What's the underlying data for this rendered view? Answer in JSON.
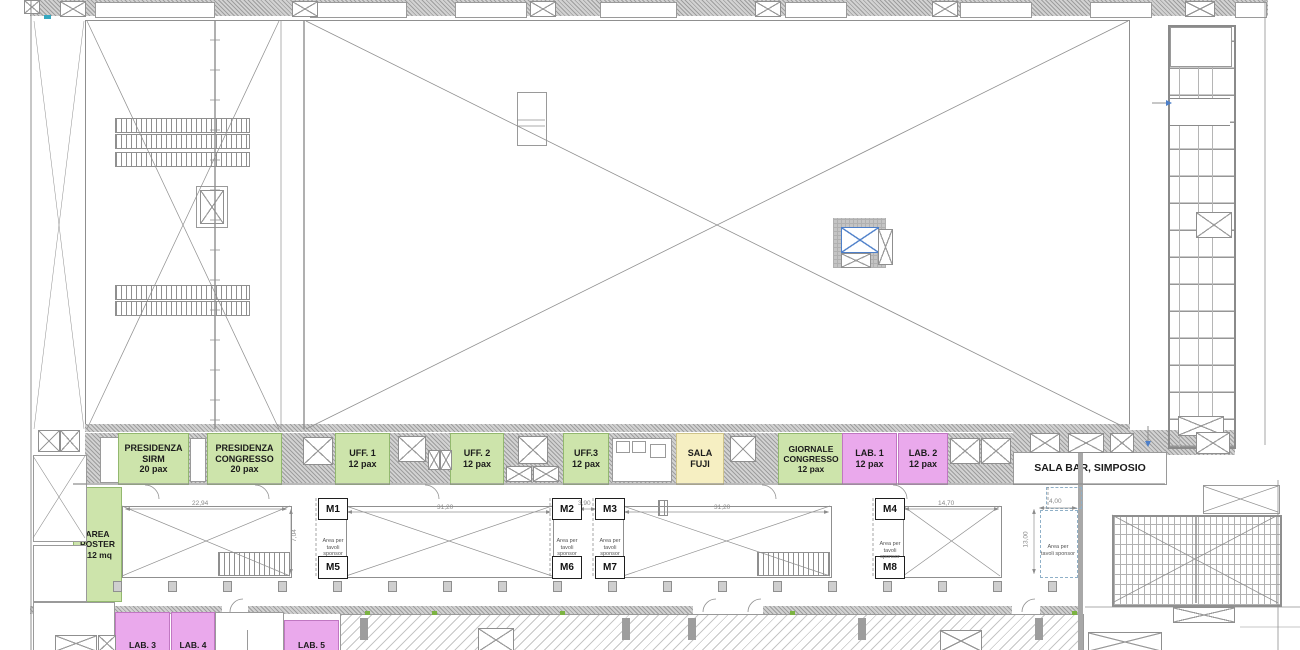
{
  "colors": {
    "room_green": "#cde4ab",
    "room_purple": "#eaa9ec",
    "room_yellow": "#f6efc2",
    "marker_blue": "#4d7fc9",
    "line_gray": "#8f8f8f"
  },
  "corridor": {
    "rooms": [
      {
        "id": "presidenza-sirm",
        "label": "PRESIDENZA\nSIRM\n20 pax",
        "color": "green"
      },
      {
        "id": "presidenza-congresso",
        "label": "PRESIDENZA\nCONGRESSO\n20 pax",
        "color": "green"
      },
      {
        "id": "uff-1",
        "label": "UFF. 1\n12 pax",
        "color": "green"
      },
      {
        "id": "uff-2",
        "label": "UFF. 2\n12 pax",
        "color": "green"
      },
      {
        "id": "uff-3",
        "label": "UFF.3\n12 pax",
        "color": "green"
      },
      {
        "id": "sala-fuji",
        "label": "SALA\nFUJI",
        "color": "yellow"
      },
      {
        "id": "giornale-congresso",
        "label": "GIORNALE\nCONGRESSO\n12 pax",
        "color": "green"
      },
      {
        "id": "lab-1",
        "label": "LAB. 1\n12 pax",
        "color": "purple"
      },
      {
        "id": "lab-2",
        "label": "LAB. 2\n12 pax",
        "color": "purple"
      }
    ],
    "sala_bar_label": "SALA BAR, SIMPOSIO"
  },
  "exhibition": {
    "poster_area_label": "AREA\nPOSTER\n112 mq",
    "sponsor_area_label": "Area per\ntavoli sponsor",
    "markers": [
      "M1",
      "M2",
      "M3",
      "M4",
      "M5",
      "M6",
      "M7",
      "M8"
    ],
    "dimensions": {
      "booth1_width": "22,94",
      "booth1_height": "7,04",
      "booth2_width": "31,20",
      "gap": "3,90",
      "booth3_width": "31,20",
      "booth4_width": "14,70",
      "sponsor_right_width": "4,00",
      "sponsor_right_height": "13,00"
    }
  },
  "bottom_rooms": [
    {
      "id": "lab-3",
      "label": "LAB. 3"
    },
    {
      "id": "lab-4",
      "label": "LAB. 4"
    },
    {
      "id": "lab-5",
      "label": "LAB. 5"
    }
  ]
}
